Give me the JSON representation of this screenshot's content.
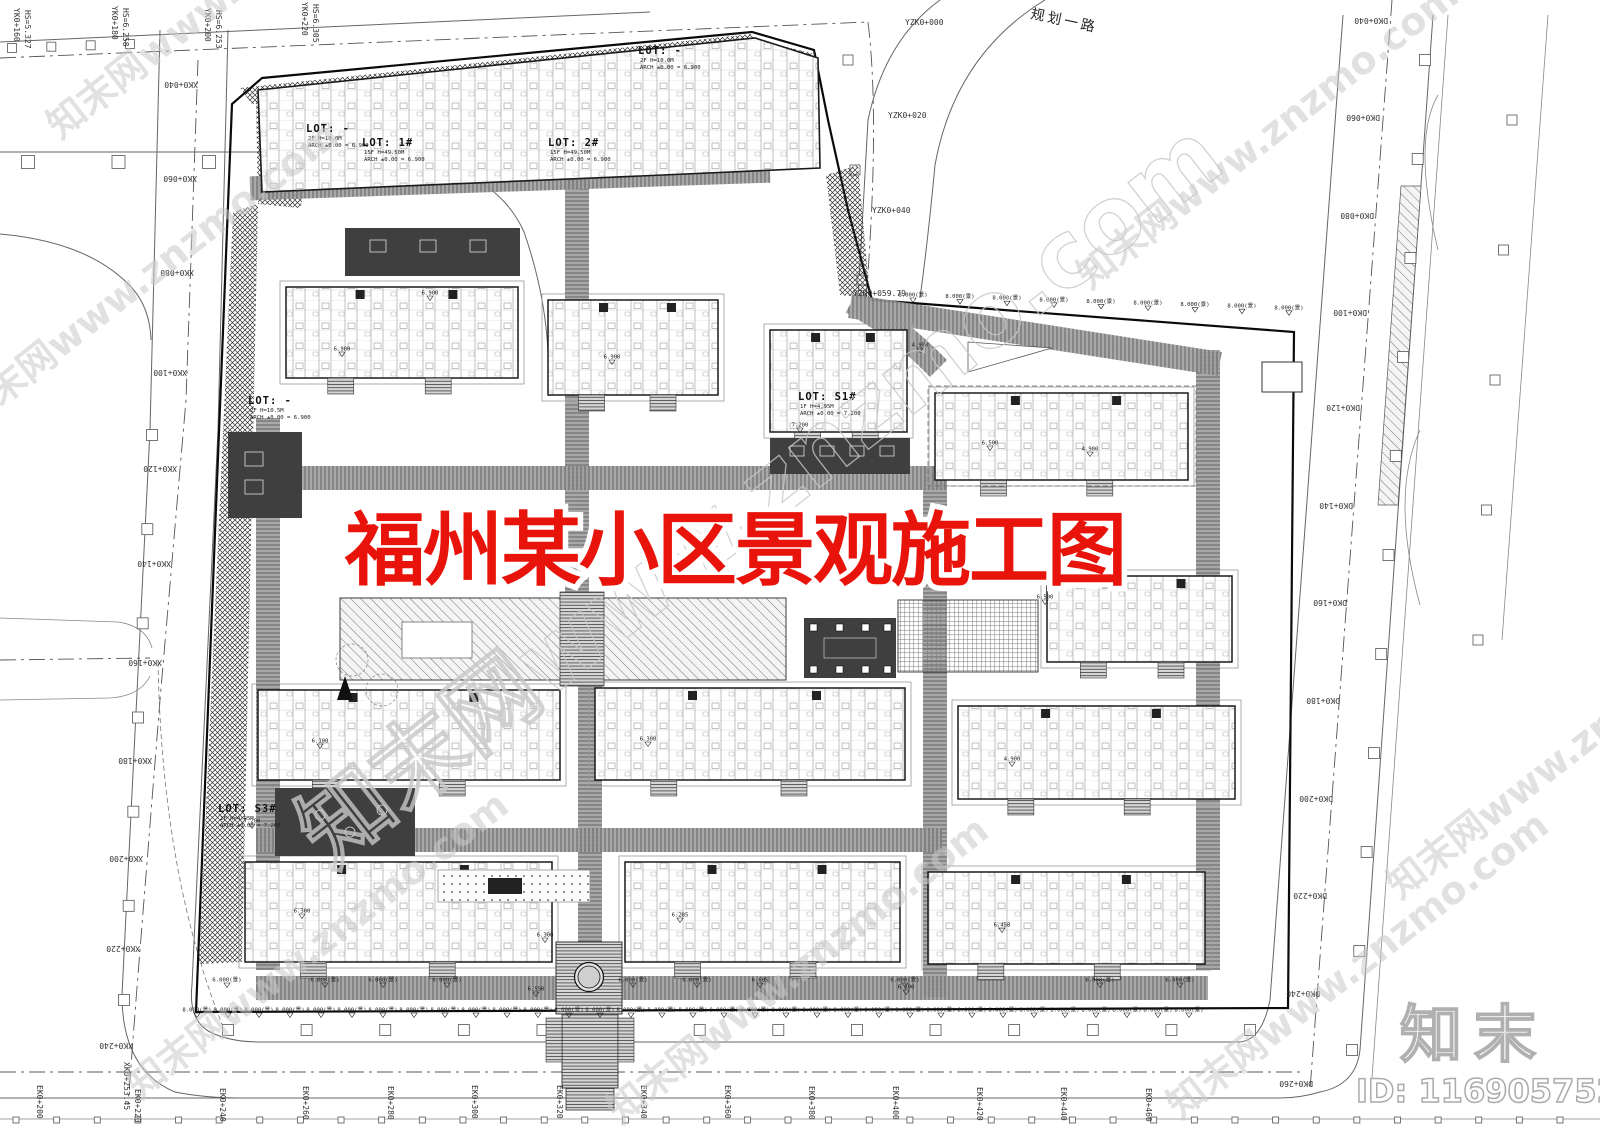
{
  "document": {
    "title": "福州某小区景观施工图",
    "title_color": "#e8130a"
  },
  "branding": {
    "watermark_text": "知末网www.znzmo.com",
    "logo_text": "知末",
    "id_text": "ID: 1169057525"
  },
  "roads": {
    "top_road_name": "规划一路",
    "chainage": [
      {
        "text": "XK0+040",
        "x": 198,
        "y": 82,
        "rot": 180
      },
      {
        "text": "XK0+060",
        "x": 197,
        "y": 176,
        "rot": 180
      },
      {
        "text": "XK0+080",
        "x": 194,
        "y": 270,
        "rot": 180
      },
      {
        "text": "XK0+100",
        "x": 187,
        "y": 370,
        "rot": 180
      },
      {
        "text": "XK0+120",
        "x": 177,
        "y": 466,
        "rot": 180
      },
      {
        "text": "XK0+140",
        "x": 171,
        "y": 561,
        "rot": 180
      },
      {
        "text": "XK0+160",
        "x": 162,
        "y": 660,
        "rot": 180
      },
      {
        "text": "XK0+180",
        "x": 152,
        "y": 758,
        "rot": 180
      },
      {
        "text": "XK0+200",
        "x": 143,
        "y": 856,
        "rot": 180
      },
      {
        "text": "XK0+220",
        "x": 140,
        "y": 946,
        "rot": 180
      },
      {
        "text": "XK0+240",
        "x": 133,
        "y": 1043,
        "rot": 180
      },
      {
        "text": "XK0+253.45",
        "x": 124,
        "y": 1062,
        "rot": 90
      },
      {
        "text": "YK0+160",
        "x": 14,
        "y": 8,
        "rot": 90
      },
      {
        "text": "HS=5.327",
        "x": 25,
        "y": 10,
        "rot": 90
      },
      {
        "text": "YK0+180",
        "x": 112,
        "y": 6,
        "rot": 90
      },
      {
        "text": "HS=6.258",
        "x": 123,
        "y": 8,
        "rot": 90
      },
      {
        "text": "YK0+200",
        "x": 205,
        "y": 8,
        "rot": 90
      },
      {
        "text": "HS=6.253",
        "x": 216,
        "y": 10,
        "rot": 90
      },
      {
        "text": "YK0+220",
        "x": 302,
        "y": 2,
        "rot": 90
      },
      {
        "text": "HS=6.305",
        "x": 313,
        "y": 4,
        "rot": 90
      },
      {
        "text": "YZK0+000",
        "x": 905,
        "y": 25,
        "rot": 0
      },
      {
        "text": "YZK0+020",
        "x": 888,
        "y": 118,
        "rot": 0
      },
      {
        "text": "YZK0+040",
        "x": 872,
        "y": 213,
        "rot": 0
      },
      {
        "text": "YZK0+059.79",
        "x": 853,
        "y": 296,
        "rot": 0
      },
      {
        "text": "DK0+040",
        "x": 1388,
        "y": 18,
        "rot": 180
      },
      {
        "text": "DK0+060",
        "x": 1380,
        "y": 115,
        "rot": 180
      },
      {
        "text": "DK0+080",
        "x": 1374,
        "y": 213,
        "rot": 180
      },
      {
        "text": "DK0+100",
        "x": 1367,
        "y": 310,
        "rot": 180
      },
      {
        "text": "DK0+120",
        "x": 1360,
        "y": 405,
        "rot": 180
      },
      {
        "text": "DK0+140",
        "x": 1353,
        "y": 503,
        "rot": 180
      },
      {
        "text": "DK0+160",
        "x": 1347,
        "y": 600,
        "rot": 180
      },
      {
        "text": "DK0+180",
        "x": 1340,
        "y": 698,
        "rot": 180
      },
      {
        "text": "DK0+200",
        "x": 1333,
        "y": 796,
        "rot": 180
      },
      {
        "text": "DK0+220",
        "x": 1327,
        "y": 893,
        "rot": 180
      },
      {
        "text": "DK0+240",
        "x": 1320,
        "y": 991,
        "rot": 180
      },
      {
        "text": "DK0+260",
        "x": 1313,
        "y": 1081,
        "rot": 180
      },
      {
        "text": "EK0+200",
        "x": 37,
        "y": 1085,
        "rot": 90
      },
      {
        "text": "EK0+220",
        "x": 135,
        "y": 1089,
        "rot": 90
      },
      {
        "text": "EK0+240",
        "x": 220,
        "y": 1088,
        "rot": 90
      },
      {
        "text": "EK0+260",
        "x": 303,
        "y": 1086,
        "rot": 90
      },
      {
        "text": "EK0+280",
        "x": 388,
        "y": 1086,
        "rot": 90
      },
      {
        "text": "EK0+300",
        "x": 472,
        "y": 1085,
        "rot": 90
      },
      {
        "text": "EK0+320",
        "x": 557,
        "y": 1085,
        "rot": 90
      },
      {
        "text": "EK0+340",
        "x": 641,
        "y": 1085,
        "rot": 90
      },
      {
        "text": "EK0+360",
        "x": 725,
        "y": 1085,
        "rot": 90
      },
      {
        "text": "EK0+380",
        "x": 809,
        "y": 1086,
        "rot": 90
      },
      {
        "text": "EK0+400",
        "x": 893,
        "y": 1086,
        "rot": 90
      },
      {
        "text": "EK0+420",
        "x": 977,
        "y": 1087,
        "rot": 90
      },
      {
        "text": "EK0+440",
        "x": 1061,
        "y": 1087,
        "rot": 90
      },
      {
        "text": "EK0+460",
        "x": 1146,
        "y": 1088,
        "rot": 90
      }
    ]
  },
  "lots": [
    {
      "label": "LOT: -",
      "x": 306,
      "y": 132,
      "subs": [
        "2F  H=10.0M",
        "ARCH ±0.00 = 6.900"
      ]
    },
    {
      "label": "LOT: 1#",
      "x": 362,
      "y": 146,
      "subs": [
        "15F  H=49.50M",
        "ARCH ±0.00 = 6.900"
      ]
    },
    {
      "label": "LOT: -",
      "x": 638,
      "y": 54,
      "subs": [
        "2F  H=10.0M",
        "ARCH ±0.00 = 6.900"
      ]
    },
    {
      "label": "LOT: 2#",
      "x": 548,
      "y": 146,
      "subs": [
        "15F  H=49.50M",
        "ARCH ±0.00 = 6.900"
      ]
    },
    {
      "label": "LOT: S1#",
      "x": 798,
      "y": 400,
      "subs": [
        "1F  H=4.95M",
        "ARCH ±0.00 = 7.200"
      ]
    },
    {
      "label": "LOT: -",
      "x": 248,
      "y": 404,
      "subs": [
        "2F  H=10.5M",
        "ARCH ±0.00 = 6.900"
      ]
    },
    {
      "label": "LOT: S3#",
      "x": 218,
      "y": 812,
      "subs": [
        "1F  H=4.95M",
        "ARCH ±0.00 = 7.200"
      ]
    }
  ],
  "elevations": {
    "rows": [
      {
        "text": "8.000(景)",
        "y": 1013,
        "x_start": 197,
        "step": 31,
        "count": 33,
        "y_step": 0
      },
      {
        "text": "8.000(景)",
        "y": 298,
        "x_start": 913,
        "step": 47,
        "count": 9,
        "y_step": 1.6
      }
    ],
    "points": [
      {
        "text": "6.000(景)",
        "x": 227,
        "y": 983
      },
      {
        "text": "6.000(景)",
        "x": 325,
        "y": 983
      },
      {
        "text": "6.000(景)",
        "x": 383,
        "y": 983
      },
      {
        "text": "6.000(景)",
        "x": 447,
        "y": 983
      },
      {
        "text": "6.000(景)",
        "x": 633,
        "y": 983
      },
      {
        "text": "6.000(景)",
        "x": 697,
        "y": 983
      },
      {
        "text": "6.000(景)",
        "x": 905,
        "y": 983
      },
      {
        "text": "6.000(景)",
        "x": 1100,
        "y": 983
      },
      {
        "text": "6.000(景)",
        "x": 1180,
        "y": 983
      },
      {
        "text": "6.900",
        "x": 342,
        "y": 352
      },
      {
        "text": "6.900",
        "x": 612,
        "y": 360
      },
      {
        "text": "6.900",
        "x": 430,
        "y": 296
      },
      {
        "text": "7.200",
        "x": 800,
        "y": 428
      },
      {
        "text": "7.200",
        "x": 252,
        "y": 824
      },
      {
        "text": "6.500",
        "x": 990,
        "y": 446
      },
      {
        "text": "4.900",
        "x": 1090,
        "y": 452
      },
      {
        "text": "6.500",
        "x": 1045,
        "y": 600
      },
      {
        "text": "6.300",
        "x": 648,
        "y": 742
      },
      {
        "text": "6.100",
        "x": 320,
        "y": 744
      },
      {
        "text": "4.900",
        "x": 1012,
        "y": 762
      },
      {
        "text": "6.300",
        "x": 302,
        "y": 914
      },
      {
        "text": "6.285",
        "x": 680,
        "y": 918
      },
      {
        "text": "6.458",
        "x": 1002,
        "y": 928
      },
      {
        "text": "6.550",
        "x": 536,
        "y": 992
      },
      {
        "text": "6.100",
        "x": 906,
        "y": 990
      },
      {
        "text": "6.605",
        "x": 760,
        "y": 983
      },
      {
        "text": "6.300",
        "x": 545,
        "y": 938
      },
      {
        "text": "4.900",
        "x": 920,
        "y": 348
      }
    ]
  }
}
